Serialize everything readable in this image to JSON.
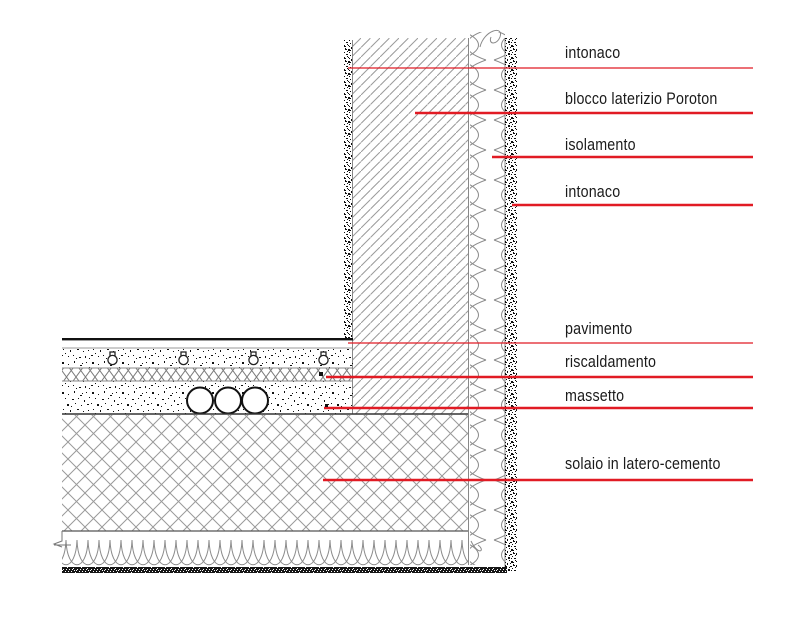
{
  "drawing_title": "wall-floor construction detail section",
  "colors": {
    "leader_red": "#e11b24",
    "hatch_gray": "#9a9a9a",
    "text_black": "#1a1a1a"
  },
  "labels": {
    "wall": [
      {
        "text": "intonaco"
      },
      {
        "text": "blocco laterizio Poroton"
      },
      {
        "text": "isolamento"
      },
      {
        "text": "intonaco"
      }
    ],
    "floor": [
      {
        "text": "pavimento"
      },
      {
        "text": "riscaldamento"
      },
      {
        "text": "massetto"
      },
      {
        "text": "solaio in latero-cemento"
      }
    ]
  }
}
